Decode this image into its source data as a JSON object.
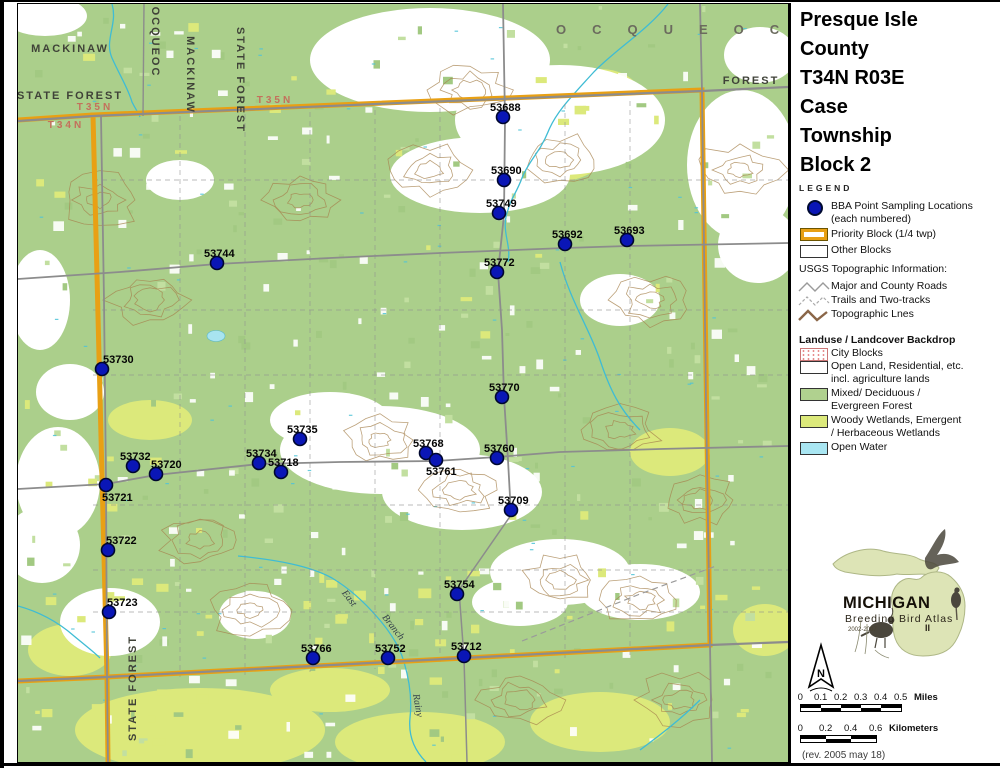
{
  "title": {
    "lines": [
      "Presque Isle",
      "County",
      "T34N R03E",
      "Case",
      "Township",
      "Block 2"
    ]
  },
  "legend": {
    "heading": "LEGEND",
    "bba_line1": "BBA Point Sampling Locations",
    "bba_line2": "(each numbered)",
    "priority_label": "Priority Block (1/4 twp)",
    "other_label": "Other Blocks",
    "usgs_heading": "USGS Topographic Information:",
    "usgs_items": [
      "Major and County Roads",
      "Trails and Two-tracks",
      "Topographic Lnes"
    ],
    "landuse_heading": "Landuse / Landcover Backdrop",
    "landuse_items": [
      {
        "swatch": "city",
        "lines": [
          "City Blocks"
        ]
      },
      {
        "swatch": "white",
        "lines": [
          "Open Land, Residential, etc.",
          "incl. agriculture lands"
        ]
      },
      {
        "swatch": "forest",
        "lines": [
          "Mixed/ Deciduous /",
          "Evergreen Forest"
        ]
      },
      {
        "swatch": "wetland",
        "lines": [
          "Woody Wetlands, Emergent",
          "/ Herbaceous Wetlands"
        ]
      },
      {
        "swatch": "water",
        "lines": [
          "Open Water"
        ]
      }
    ]
  },
  "logo": {
    "name": "MICHIGAN",
    "subtitle": "Breeding Bird Atlas",
    "years": "2002-2007",
    "numeral": "II"
  },
  "north_label": "N",
  "scalebars": {
    "miles": {
      "ticks": [
        "0",
        "0.1",
        "0.2",
        "0.3",
        "0.4",
        "0.5"
      ],
      "unit": "Miles",
      "segpx": 20
    },
    "km": {
      "ticks": [
        "0",
        "0.2",
        "0.4",
        "0.6"
      ],
      "unit": "Kilometers",
      "segpx": 25
    }
  },
  "revision": "(rev. 2005 may 18)",
  "colors": {
    "forest_green": "#abcf8b",
    "wetland_green": "#dce97b",
    "open_water": "#a9e6f2",
    "priority_orange": "#e8a014",
    "point_blue": "#0a16b6"
  },
  "map": {
    "points": [
      {
        "id": "53688",
        "x": 503,
        "y": 117
      },
      {
        "id": "53690",
        "x": 504,
        "y": 180
      },
      {
        "id": "53749",
        "x": 499,
        "y": 213
      },
      {
        "id": "53692",
        "x": 565,
        "y": 244
      },
      {
        "id": "53693",
        "x": 627,
        "y": 240
      },
      {
        "id": "53744",
        "x": 217,
        "y": 263
      },
      {
        "id": "53772",
        "x": 497,
        "y": 272
      },
      {
        "id": "53730",
        "x": 102,
        "y": 369,
        "dx": 1
      },
      {
        "id": "53770",
        "x": 502,
        "y": 397
      },
      {
        "id": "53735",
        "x": 300,
        "y": 439
      },
      {
        "id": "53768",
        "x": 426,
        "y": 453
      },
      {
        "id": "53760",
        "x": 497,
        "y": 458
      },
      {
        "id": "53761",
        "x": 436,
        "y": 460,
        "dx": -10,
        "dy": 15
      },
      {
        "id": "53734",
        "x": 259,
        "y": 463
      },
      {
        "id": "53732",
        "x": 133,
        "y": 466
      },
      {
        "id": "53718",
        "x": 281,
        "y": 472
      },
      {
        "id": "53720",
        "x": 156,
        "y": 474,
        "dx": -5
      },
      {
        "id": "53721",
        "x": 106,
        "y": 485,
        "dx": -4,
        "dy": 16
      },
      {
        "id": "53709",
        "x": 511,
        "y": 510
      },
      {
        "id": "53722",
        "x": 108,
        "y": 550,
        "dx": -2
      },
      {
        "id": "53754",
        "x": 457,
        "y": 594
      },
      {
        "id": "53723",
        "x": 109,
        "y": 612,
        "dx": -2
      },
      {
        "id": "53712",
        "x": 464,
        "y": 656
      },
      {
        "id": "53766",
        "x": 313,
        "y": 658,
        "dx": -12
      },
      {
        "id": "53752",
        "x": 388,
        "y": 658
      }
    ],
    "labels": [
      {
        "text": "MACKINAW",
        "x": 70,
        "y": 52,
        "cls": "forest"
      },
      {
        "text": "STATE FOREST",
        "x": 70,
        "y": 99,
        "cls": "forest"
      },
      {
        "text": "T35N",
        "x": 95,
        "y": 110,
        "cls": "twp"
      },
      {
        "text": "T34N",
        "x": 66,
        "y": 128,
        "cls": "twp"
      },
      {
        "text": "T35N",
        "x": 275,
        "y": 103,
        "cls": "twp"
      },
      {
        "text": "OCQUEOC",
        "x": 152,
        "y": 42,
        "cls": "forest-v",
        "rot": 90
      },
      {
        "text": "MACKINAW",
        "x": 187,
        "y": 75,
        "cls": "forest-v",
        "rot": 90
      },
      {
        "text": "STATE FOREST",
        "x": 237,
        "y": 80,
        "cls": "forest-v",
        "rot": 90
      },
      {
        "text": "OCQUEOC",
        "x": 556,
        "y": 34,
        "cls": "county",
        "ls": 26,
        "anchor": "start"
      },
      {
        "text": "FOREST",
        "x": 751,
        "y": 84,
        "cls": "forest"
      },
      {
        "text": "STATE FOREST",
        "x": 136,
        "y": 688,
        "cls": "forest-v",
        "rot": -90
      },
      {
        "text": "East",
        "x": 347,
        "y": 600,
        "cls": "stream",
        "rot": 52
      },
      {
        "text": "Branch",
        "x": 391,
        "y": 629,
        "cls": "stream",
        "rot": 52
      },
      {
        "text": "Rainy",
        "x": 415,
        "y": 706,
        "cls": "stream",
        "rot": 80
      }
    ]
  }
}
